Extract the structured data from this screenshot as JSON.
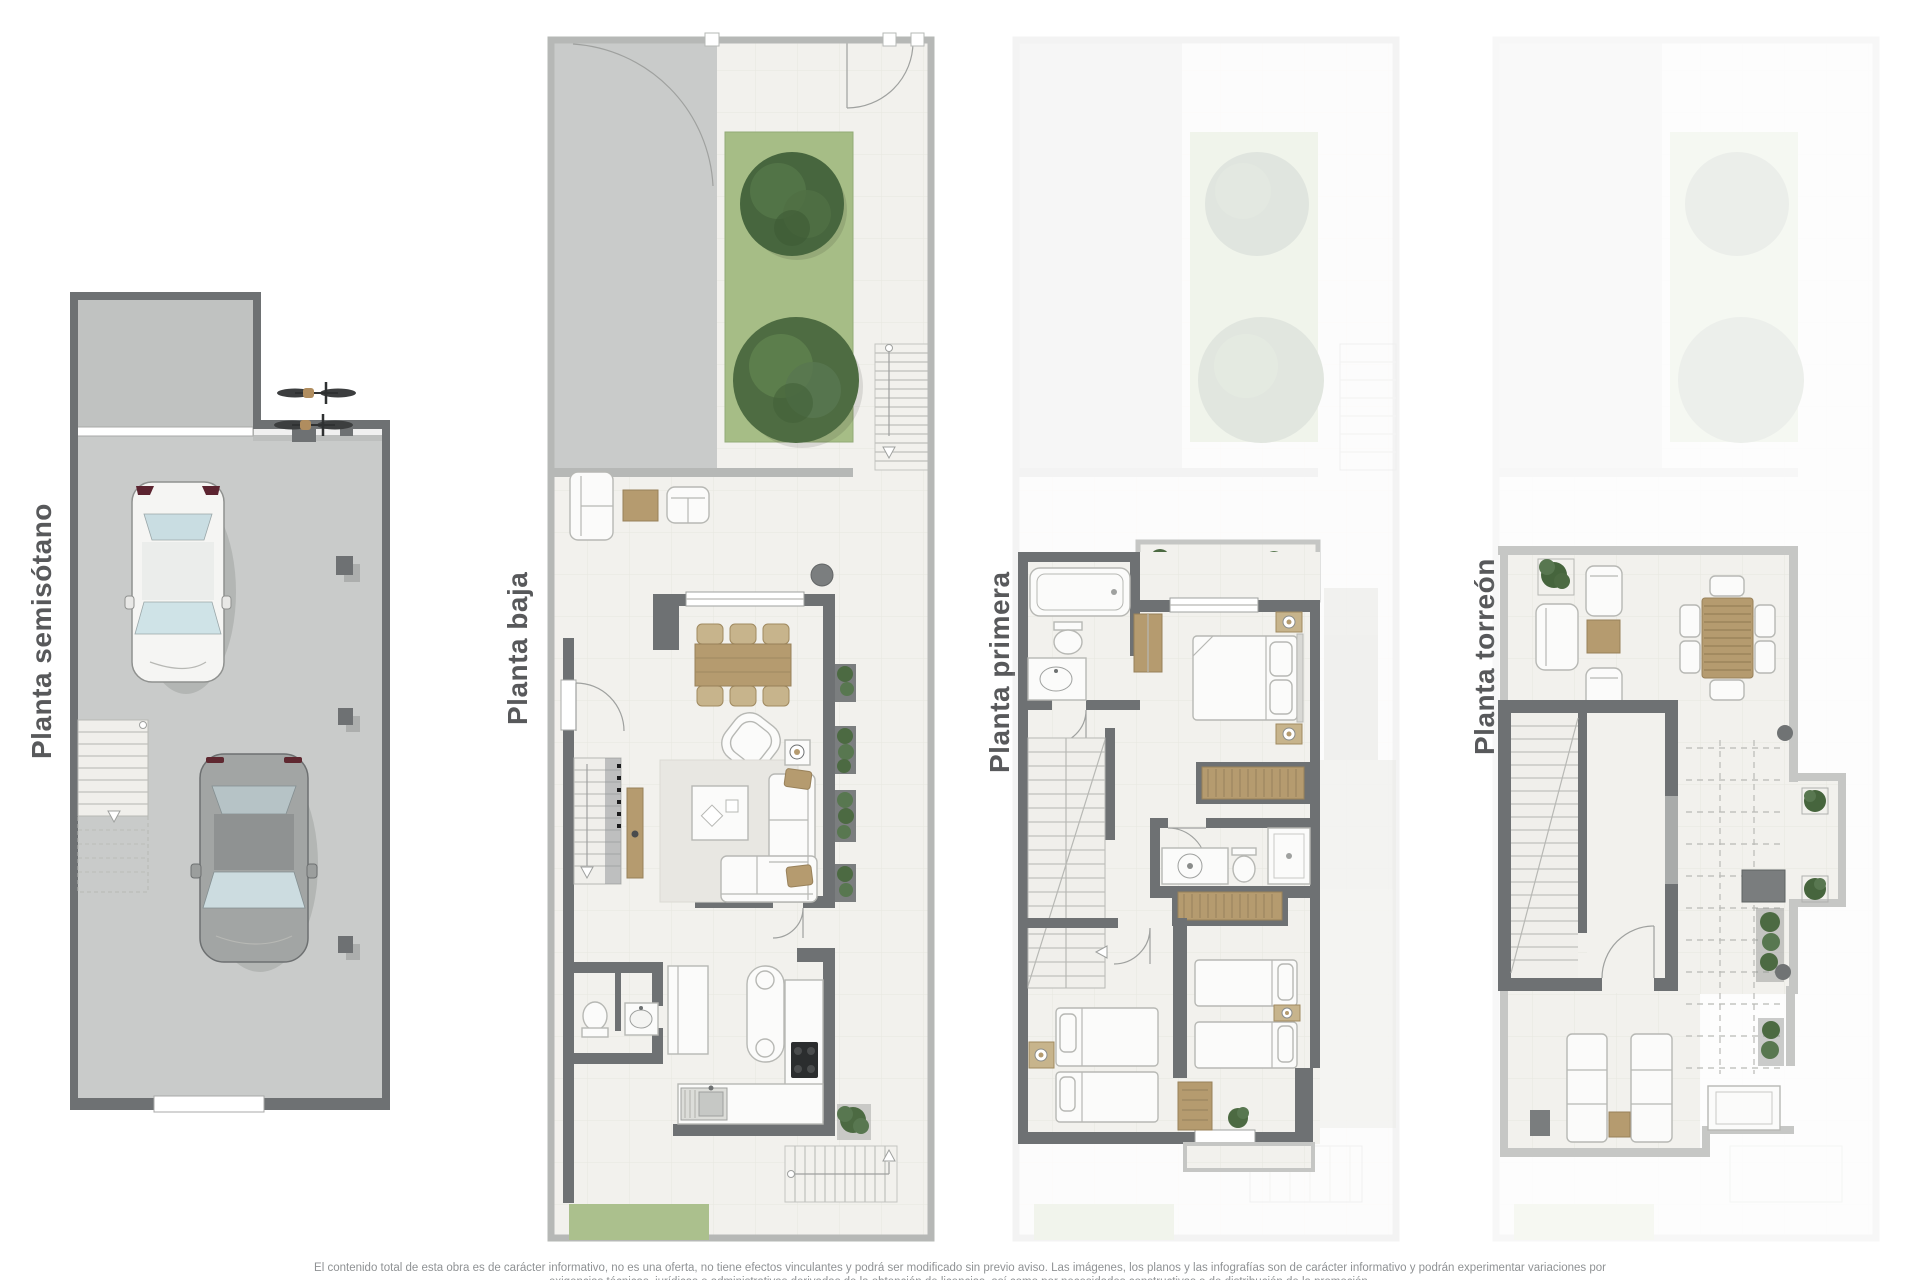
{
  "plans": [
    {
      "id": "semisotano",
      "label": "Planta semisótano"
    },
    {
      "id": "baja",
      "label": "Planta baja"
    },
    {
      "id": "primera",
      "label": "Planta primera"
    },
    {
      "id": "torreon",
      "label": "Planta torreón"
    }
  ],
  "disclaimer": {
    "line1": "El contenido total de esta obra es de carácter informativo, no es una oferta, no tiene efectos vinculantes y podrá ser modificado sin previo aviso. Las imágenes, los planos y las infografías son de carácter informativo y podrán experimentar variaciones por",
    "line2": "exigencias técnicas, jurídicas o administrativas derivadas de la obtención de licencias, así como por necesidades constructivas o de distribución de la promoción."
  },
  "colors": {
    "wall_dark": "#6e7173",
    "wall_light": "#b6b8b6",
    "floor_concrete": "#c9cbca",
    "floor_interior": "#f2f1ed",
    "grass": "#a6bd86",
    "tree": "#47663e",
    "wood": "#b59b6f",
    "label_text": "#58595b",
    "disclaimer_text": "#8f9294"
  }
}
